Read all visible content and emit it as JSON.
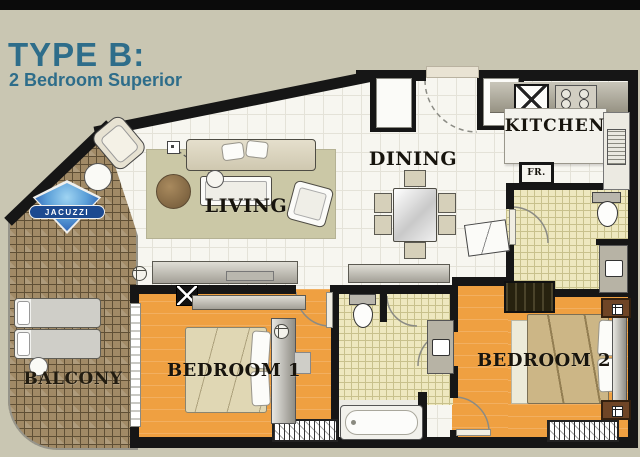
{
  "header": {
    "title": "TYPE B:",
    "subtitle": "2 Bedroom Superior"
  },
  "labels": {
    "living": "LIVING",
    "dining": "DINING",
    "kitchen": "KITCHEN",
    "fridge": "FR.",
    "bedroom1": "BEDROOM 1",
    "bedroom2": "BEDROOM 2",
    "balcony": "BALCONY",
    "jacuzzi": "JACUZZI"
  },
  "colors": {
    "background": "#c9c6b2",
    "title_teal": "#2e6d8a",
    "wall_black": "#161616",
    "bedroom_orange": "#efa041",
    "bath_tile_yellow": "#eee8bf",
    "balcony_brown": "#a18a66",
    "floor_white": "#f7f6f0",
    "jacuzzi_blue": "#1d4a90",
    "label_ink": "#17140d"
  }
}
